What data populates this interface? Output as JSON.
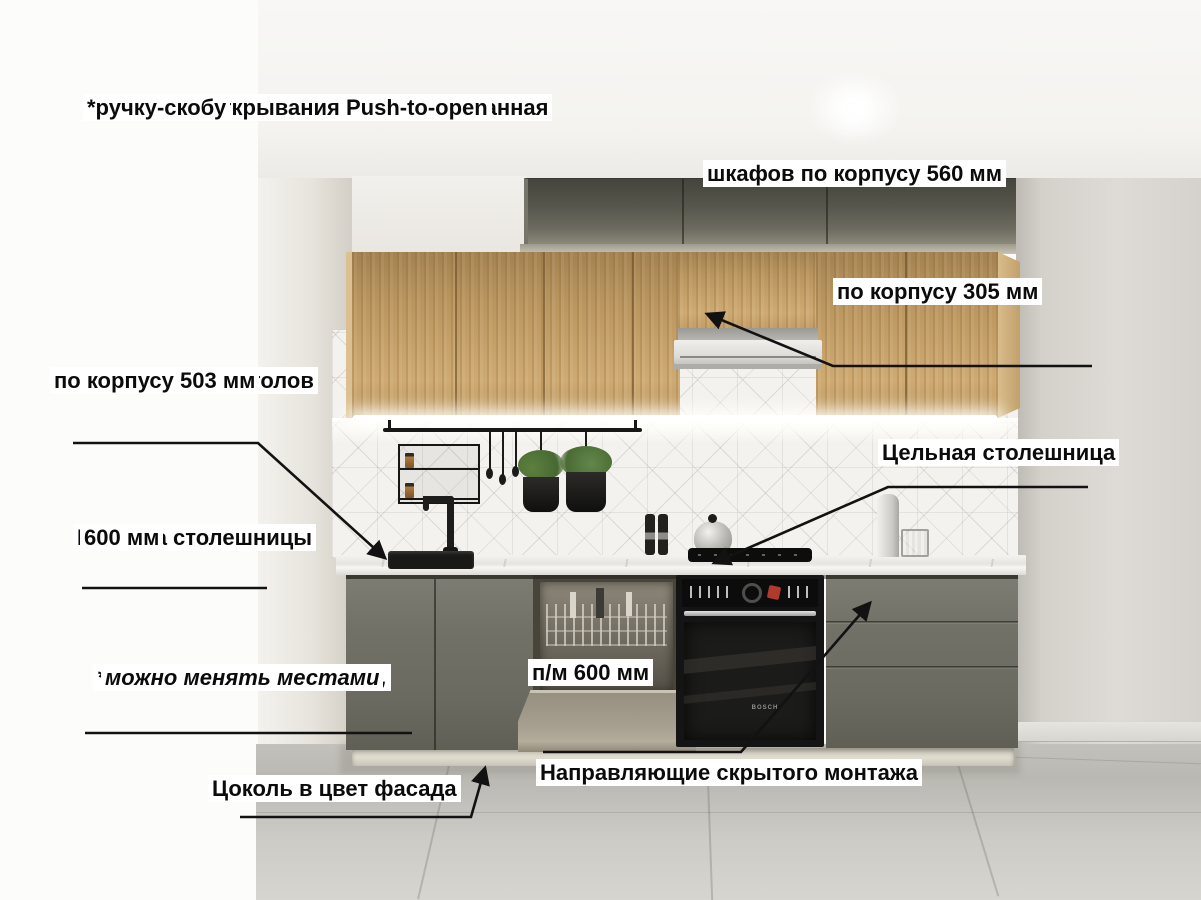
{
  "annotations": {
    "note_handles": {
      "lines": [
        "Нижние шкафы — ручка интегрированная",
        "в фасад.",
        "Верхние шкафы - можно установить",
        "(приобретаются дополнительно):",
        "*накладную ручку",
        "*механизм открывания Push-to-open",
        "*ручку-скобу"
      ]
    },
    "upper_depth": {
      "lines": [
        "Глубина верхних",
        "шкафов по корпусу 560 мм"
      ]
    },
    "mid_upper_depth": {
      "lines": [
        "Глубина средних",
        "верхних шкафов",
        "по корпусу 305 мм"
      ]
    },
    "base_depth": {
      "lines": [
        "Глубина нижних столов",
        "по корпусу 503 мм"
      ]
    },
    "solid_countertop": {
      "lines": [
        "Цельная столешница"
      ]
    },
    "countertop_depth": {
      "lines": [
        "Глубина столешницы",
        "600 мм"
      ]
    },
    "modules_note": {
      "lines": [
        "* Все модули раздельные,",
        "можно менять местами"
      ]
    },
    "dishwasher_front": {
      "lines": [
        "Фасад для",
        "п/м 600 мм"
      ]
    },
    "plinth_note": {
      "lines": [
        "Цоколь в цвет фасада"
      ]
    },
    "drawer_mechanism": {
      "lines": [
        "Механизм выдвижения ящиков -",
        "Направляющие скрытого монтажа"
      ]
    }
  },
  "scene": {
    "oven_brand": "BOSCH"
  },
  "colors": {
    "annotation_text": "#0b0b0b",
    "annotation_bg": "#ffffff",
    "arrow": "#121212",
    "wood_front": "#c9a267",
    "upper_cabinet_gray": "#55544a",
    "base_cabinet_gray": "#6f6e64",
    "countertop": "#eceae5",
    "backsplash_tile": "#f4f2ee",
    "wall": "#dad7d2",
    "floor": "#c6c4be",
    "led_light": "#ffffff"
  }
}
